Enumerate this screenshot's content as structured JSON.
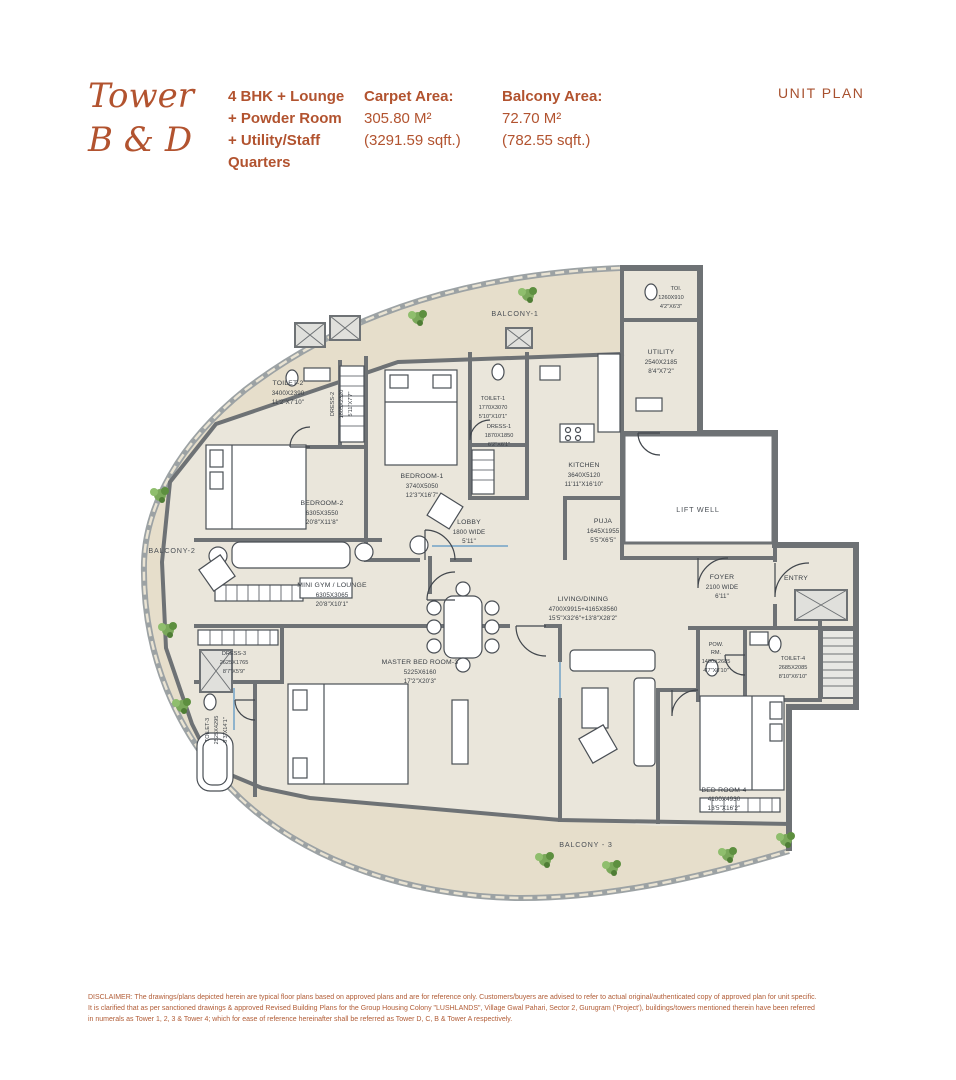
{
  "header": {
    "tower_line1": "Tower",
    "tower_line2": "B & D",
    "config_lines": [
      "4 BHK + Lounge",
      "+ Powder Room",
      "+ Utility/Staff",
      "Quarters"
    ],
    "carpet": {
      "label": "Carpet Area:",
      "m2": "305.80 M²",
      "sqft": "(3291.59 sqft.)"
    },
    "balcony": {
      "label": "Balcony Area:",
      "m2": "72.70 M²",
      "sqft": "(782.55 sqft.)"
    },
    "unit_plan": "UNIT PLAN"
  },
  "plan": {
    "labels": {
      "balcony1": "BALCONY-1",
      "balcony2": "BALCONY-2",
      "balcony3": "BALCONY - 3",
      "lift_well": "LIFT WELL",
      "entry": "ENTRY",
      "toi": {
        "n": "TOI.",
        "mm": "1260X910",
        "ft": "4'2\"X6'3\""
      },
      "utility": {
        "n": "UTILITY",
        "mm": "2540X2185",
        "ft": "8'4\"X7'2\""
      },
      "toilet2": {
        "n": "TOILET-2",
        "mm": "3400X2390",
        "ft": "11'2\"X7'10\""
      },
      "dress2": {
        "n": "DRESS-2",
        "mm": "1805X2320",
        "ft": "5'11\"X7'7\""
      },
      "bedroom1": {
        "n": "BEDROOM-1",
        "mm": "3740X5050",
        "ft": "12'3\"X16'7\""
      },
      "toilet1": {
        "n": "TOILET-1",
        "mm": "1770X3070",
        "ft": "5'10\"X10'1\""
      },
      "dress1": {
        "n": "DRESS-1",
        "mm": "1870X1850",
        "ft": "6'2\"X6'1\""
      },
      "kitchen": {
        "n": "KITCHEN",
        "mm": "3640X5120",
        "ft": "11'11\"X16'10\""
      },
      "bedroom2": {
        "n": "BEDROOM-2",
        "mm": "6305X3550",
        "ft": "20'8\"X11'8\""
      },
      "lobby": {
        "n": "LOBBY",
        "mm": "1800 WIDE",
        "ft": "5'11\""
      },
      "puja": {
        "n": "PUJA",
        "mm": "1645X1955",
        "ft": "5'5\"X6'5\""
      },
      "minigym": {
        "n": "MINI GYM / LOUNGE",
        "mm": "6305X3065",
        "ft": "20'8\"X10'1\""
      },
      "foyer": {
        "n": "FOYER",
        "mm": "2100 WIDE",
        "ft": "6'11\""
      },
      "dress3": {
        "n": "DRESS-3",
        "mm": "2625X1765",
        "ft": "8'7\"X5'9\""
      },
      "master": {
        "n": "MASTER BED ROOM-3",
        "mm": "5225X6160",
        "ft": "17'2\"X20'3\""
      },
      "living": {
        "n": "LIVING/DINING",
        "mm": "4700X9915+4165X8560",
        "ft": "15'5\"X32'6\"+13'8\"X28'2\""
      },
      "powrm": {
        "n": "POW.",
        "n2": "RM.",
        "mm": "1400X2685",
        "ft": "4'7\"X8'10\""
      },
      "toilet4": {
        "n": "TOILET-4",
        "mm": "2685X2085",
        "ft": "8'10\"X6'10\""
      },
      "toilet3": {
        "n": "TOILET-3",
        "mm": "2525X4295",
        "ft": "8'3\"X14'1\""
      },
      "bedroom4": {
        "n": "BED ROOM-4",
        "mm": "4100X4930",
        "ft": "13'5\"X16'2\""
      }
    },
    "colors": {
      "accent": "#b2532f",
      "wall": "#6e7275",
      "floor": "#eae6db",
      "balcony_floor": "#e6decb"
    }
  },
  "disclaimer": {
    "lines": [
      "DISCLAIMER: The drawings/plans depicted herein are typical floor plans based on approved plans and are for reference only. Customers/buyers are advised to refer to actual original/authenticated copy of approved plan for unit specific.",
      "It is clarified that as per sanctioned drawings & approved Revised Building Plans for the Group Housing Colony \"LUSHLANDS\", Village Gwal Pahari, Sector 2, Gurugram ('Project'), buildings/towers mentioned therein have been referred",
      "in numerals as Tower 1, 2, 3 & Tower 4; which for ease of reference hereinafter shall be referred as Tower D, C, B & Tower A respectively."
    ]
  }
}
